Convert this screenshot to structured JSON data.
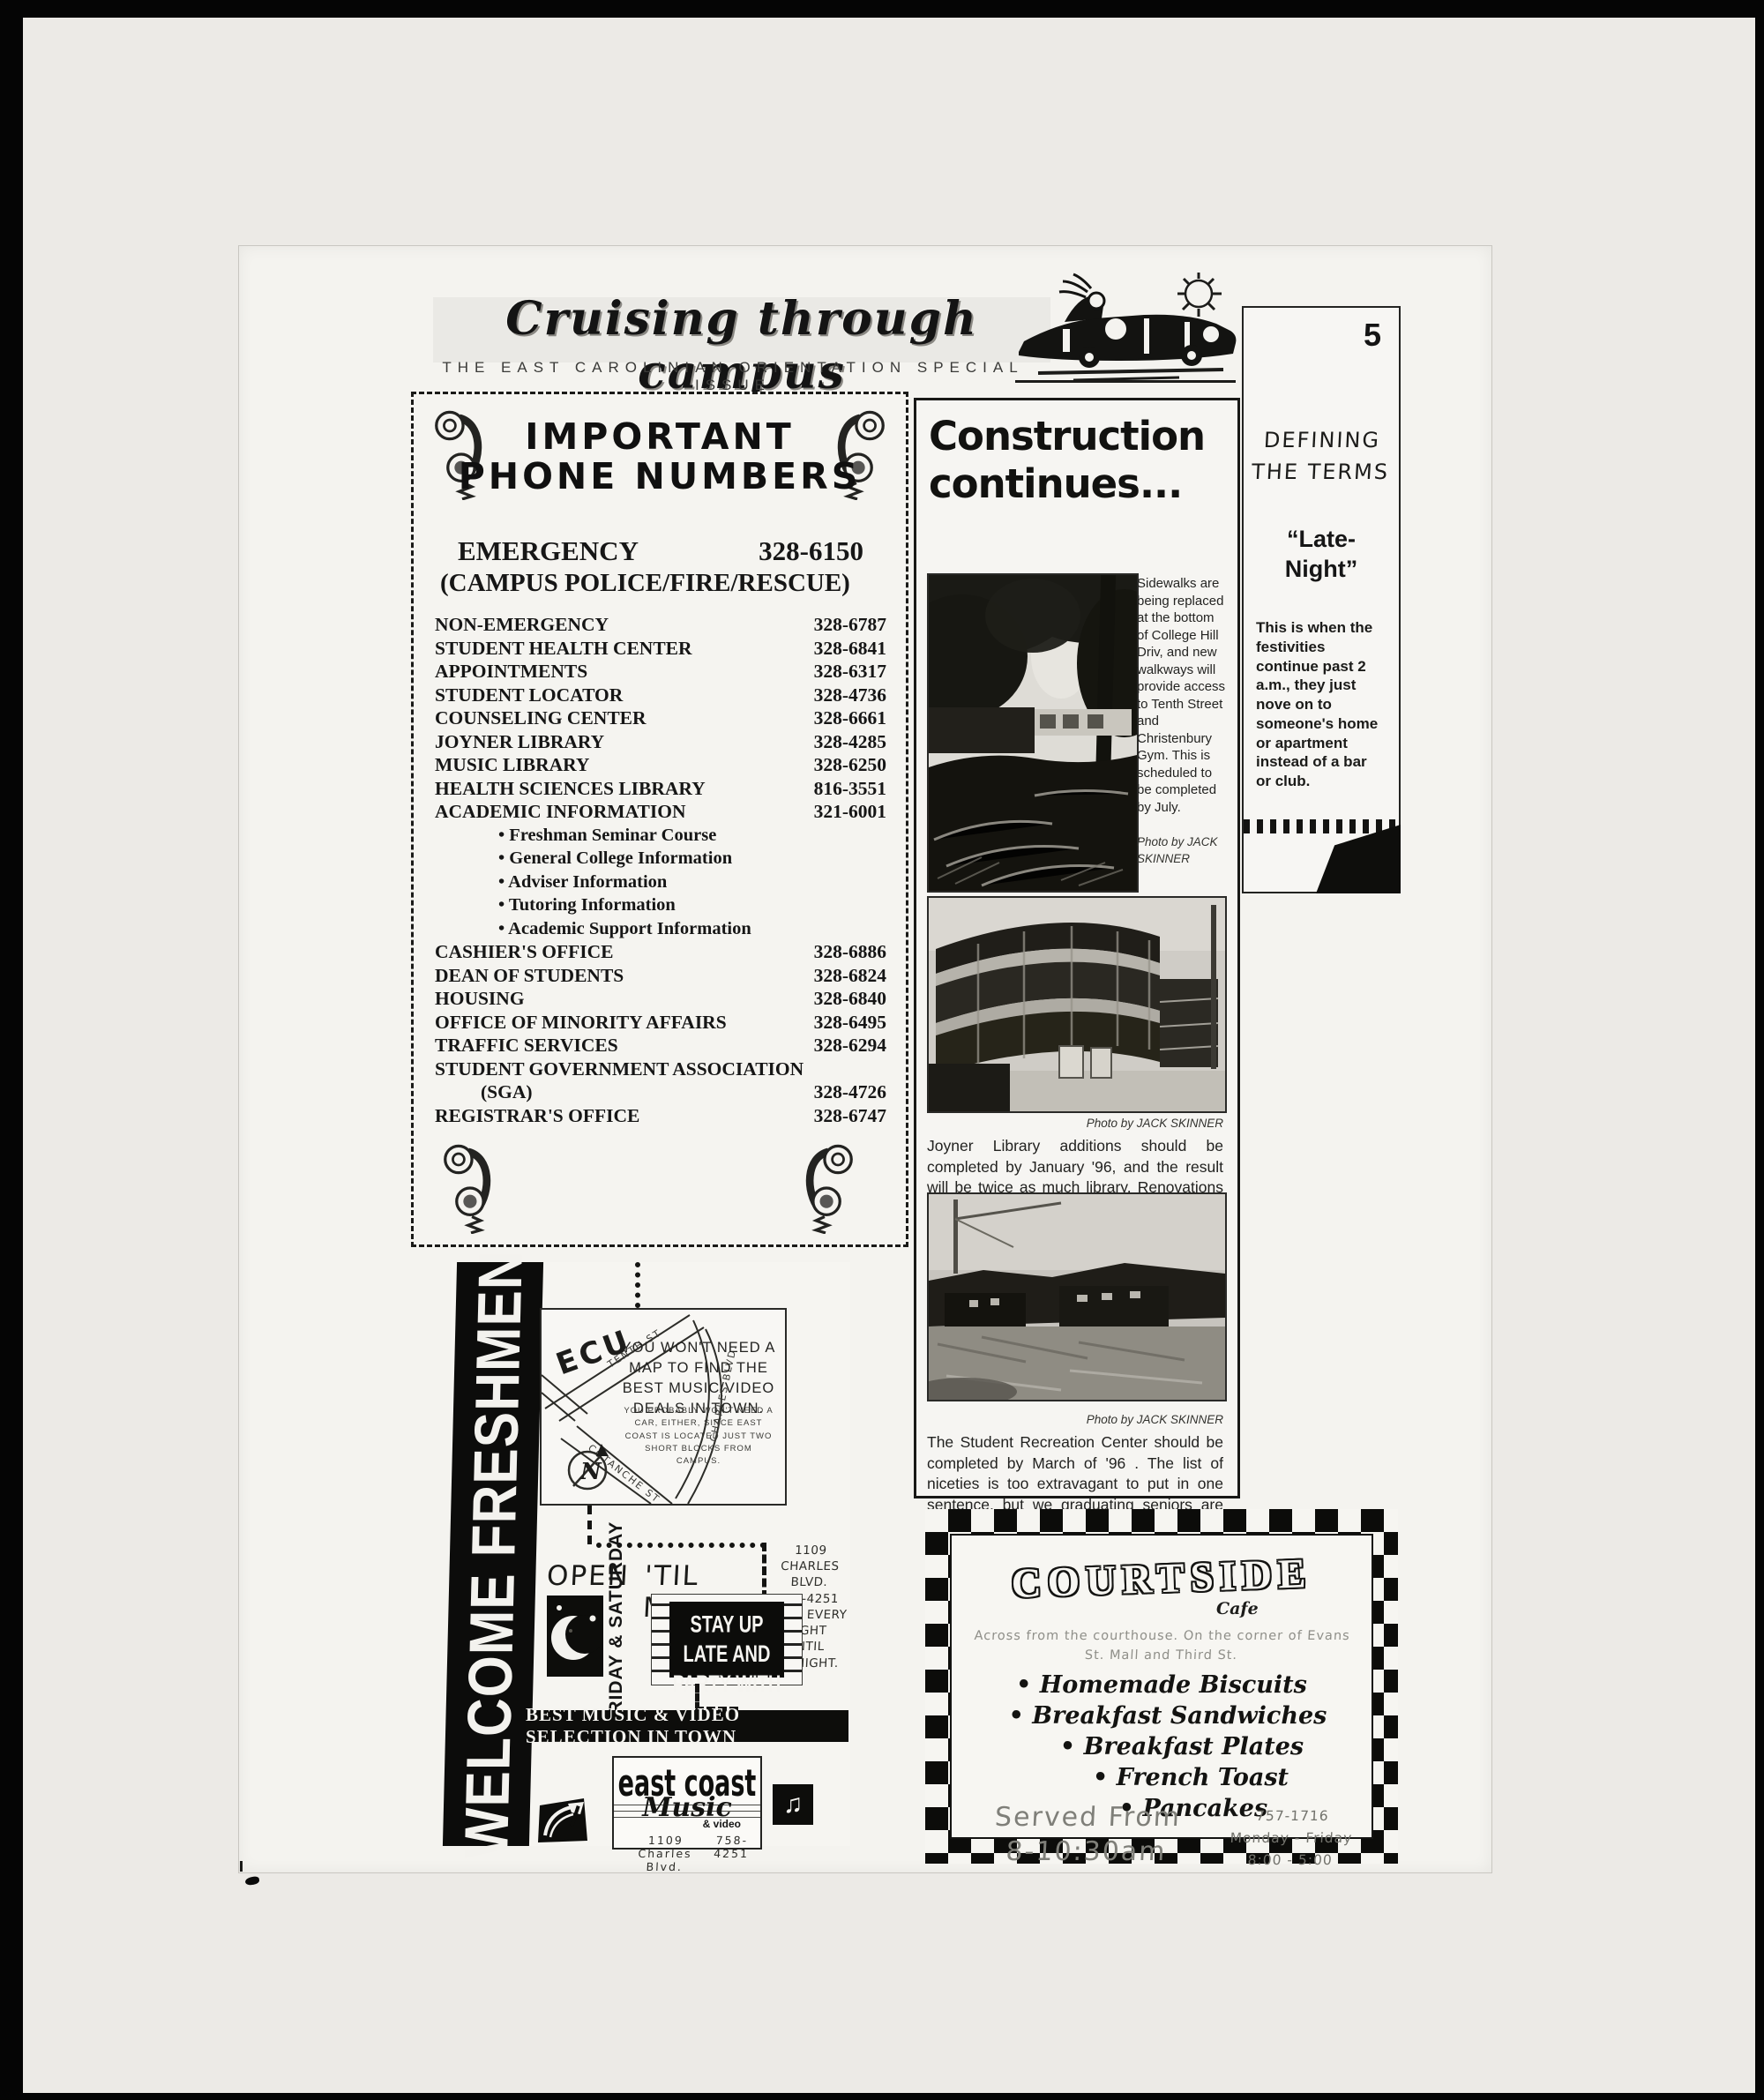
{
  "colors": {
    "ink": "#141412",
    "paper": "#f4f3ef"
  },
  "header": {
    "title": "Cruising through campus",
    "subtitle": "THE EAST CAROLINIAN ORIENTATION SPECIAL ISSUE",
    "page_number": "5"
  },
  "defining": {
    "heading_line1": "DEFINING",
    "heading_line2": "THE TERMS",
    "term_line1": "“Late-",
    "term_line2": "Night”",
    "body": "This is when the festivities continue past 2 a.m., they just nove on to someone's home or apartment instead of a bar or club."
  },
  "phone": {
    "title_line1": "IMPORTANT",
    "title_line2": "PHONE NUMBERS",
    "emergency_label": "EMERGENCY",
    "emergency_number": "328-6150",
    "emergency_sub": "(CAMPUS POLICE/FIRE/RESCUE)",
    "rows": [
      {
        "label": "NON-EMERGENCY",
        "number": "328-6787"
      },
      {
        "label": "STUDENT HEALTH CENTER",
        "number": "328-6841"
      },
      {
        "label": "APPOINTMENTS",
        "number": "328-6317"
      },
      {
        "label": "STUDENT LOCATOR",
        "number": "328-4736"
      },
      {
        "label": "COUNSELING CENTER",
        "number": "328-6661"
      },
      {
        "label": "JOYNER LIBRARY",
        "number": "328-4285"
      },
      {
        "label": "MUSIC LIBRARY",
        "number": "328-6250"
      },
      {
        "label": "HEALTH SCIENCES LIBRARY",
        "number": "816-3551"
      },
      {
        "label": "ACADEMIC INFORMATION",
        "number": "321-6001"
      }
    ],
    "bullets": [
      "• Freshman Seminar Course",
      "• General College Information",
      "• Adviser Information",
      "• Tutoring Information",
      "• Academic Support Information"
    ],
    "rows2": [
      {
        "label": "CASHIER'S OFFICE",
        "number": "328-6886"
      },
      {
        "label": "DEAN OF STUDENTS",
        "number": "328-6824"
      },
      {
        "label": "HOUSING",
        "number": "328-6840"
      },
      {
        "label": "OFFICE OF MINORITY AFFAIRS",
        "number": "328-6495"
      },
      {
        "label": "TRAFFIC SERVICES",
        "number": "328-6294"
      }
    ],
    "sga_label": "STUDENT GOVERNMENT ASSOCIATION",
    "sga_sub": "(SGA)",
    "sga_number": "328-4726",
    "registrar_label": "REGISTRAR'S OFFICE",
    "registrar_number": "328-6747"
  },
  "construction": {
    "headline_line1": "Construction",
    "headline_line2": "continues...",
    "photo1_caption": "Sidewalks are being replaced at the bottom of College Hill Driv, and new walkways will provide access to Tenth Street and Christenbury Gym. This is scheduled to be completed by July.",
    "photo1_credit": "Photo by JACK SKINNER",
    "photo2_credit": "Photo by JACK SKINNER",
    "photo2_caption": "Joyner Library additions should be completed by January '96, and the result will be twice as much library. Renovations will be finished mid-1997.",
    "photo3_credit": "Photo by JACK SKINNER",
    "photo3_caption": "The Student Recreation Center should be completed by March of '96 . The list of niceties is too extravagant to put in one sentence, but we graduating seniors are JEALOUS!"
  },
  "music_ad": {
    "banner": "WELCOME FRESHMEN",
    "map": {
      "ecu": "ECU",
      "tenth": "TENTH ST",
      "charles": "CHARLES BLVD.",
      "cotanche": "COTANCHE ST",
      "compass": "N"
    },
    "headline": "YOU WON'T NEED A MAP TO FIND THE BEST MUSIC/VIDEO DEALS IN TOWN.",
    "subtext": "YOU PROBABLY WON'T NEED A CAR, EITHER, SINCE EAST COAST IS LOCATED JUST TWO SHORT BLOCKS FROM CAMPUS.",
    "address_block": "1109 CHARLES BLVD.\n758-4251\nOPEN EVERY\nNIGHT UNTIL\nMIDNIGHT.",
    "open_label": "OPEN",
    "days_vertical": "FRIDAY & SATURDAY",
    "til_label": "'TIL MIDNIGHT",
    "marquee_line1": "STAY UP LATE AND",
    "marquee_line2": "PARTY WITH US",
    "marquee_address": "1109 Charles Blvd., Greenville",
    "bar": "BEST MUSIC & VIDEO SELECTION IN TOWN",
    "logo_line1": "east coast",
    "logo_line2": "Music",
    "logo_line3": "& video",
    "logo_address": "1109 Charles Blvd.",
    "logo_phone": "758-4251"
  },
  "courtside": {
    "name": "COURTSIDE",
    "cafe": "Cafe",
    "location": "Across from the courthouse.  On the corner of Evans\nSt. Mall and Third St.",
    "menu": [
      "• Homemade Biscuits",
      "• Breakfast Sandwiches",
      "• Breakfast Plates",
      "• French Toast",
      "• Pancakes"
    ],
    "served_line1": "Served From",
    "served_line2": "8-10:30am",
    "phone": "757-1716",
    "days": "Monday - Friday",
    "hours": "8:00 - 5:00"
  }
}
